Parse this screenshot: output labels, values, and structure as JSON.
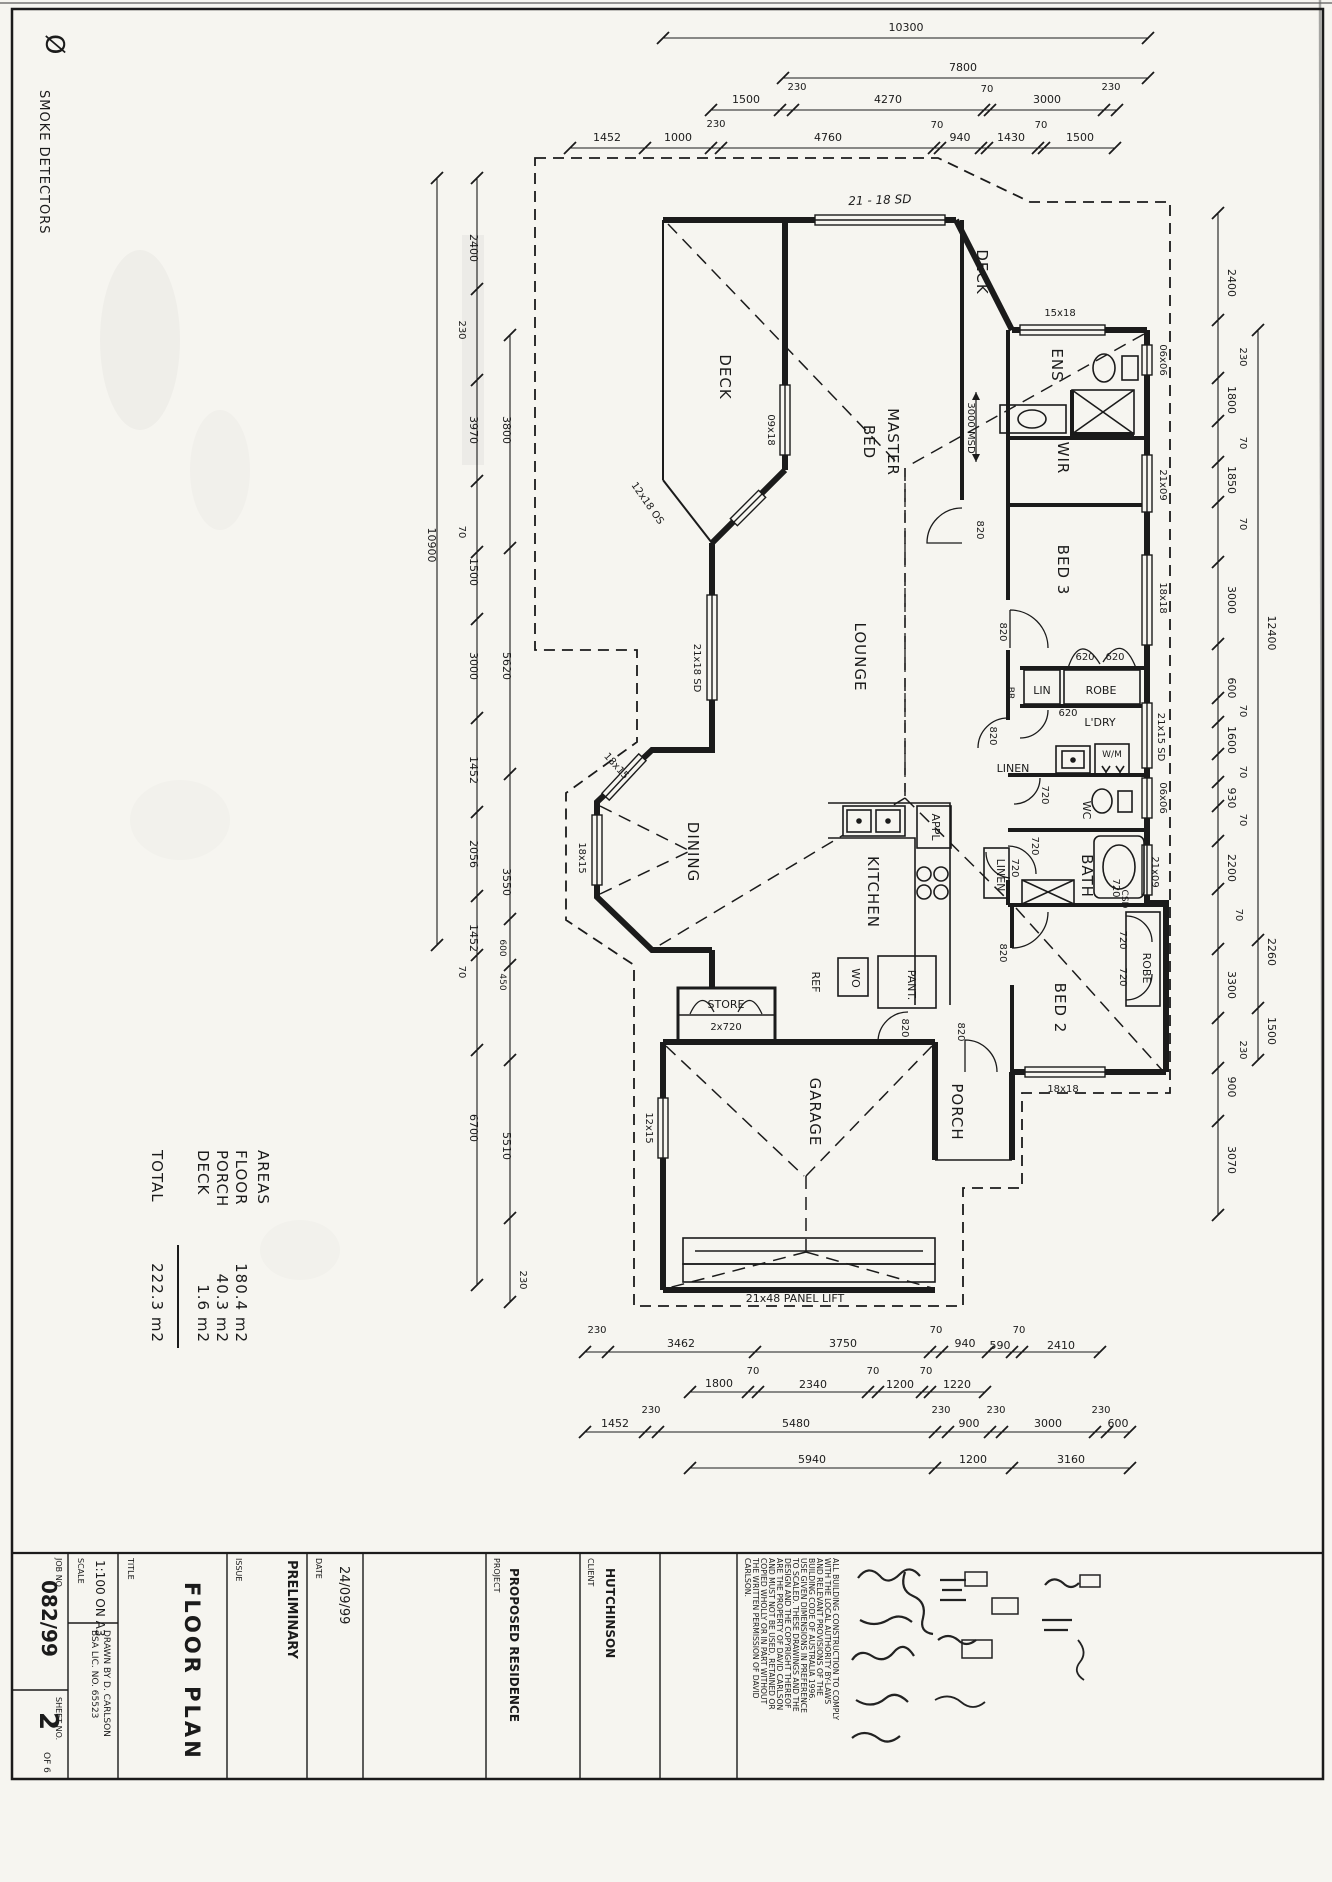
{
  "legend": {
    "symbol": "Ø",
    "label": "SMOKE DETECTORS"
  },
  "areas": {
    "title": "AREAS",
    "rows": [
      {
        "label": "FLOOR",
        "value": "180.4 m2"
      },
      {
        "label": "PORCH",
        "value": "40.3 m2"
      },
      {
        "label": "DECK",
        "value": "1.6 m2"
      }
    ],
    "total_label": "TOTAL",
    "total_value": "222.3 m2"
  },
  "rooms": {
    "deck_a": "DECK",
    "deck_b": "DECK",
    "master_1": "MASTER",
    "master_2": "BED",
    "ens": "ENS",
    "wir": "WIR",
    "bed3": "BED 3",
    "lounge": "LOUNGE",
    "dining": "DINING",
    "kitchen": "KITCHEN",
    "ldry": "L'DRY",
    "bath": "BATH",
    "bed2": "BED 2",
    "garage": "GARAGE",
    "porch": "PORCH",
    "store": "STORE",
    "wc": "WC",
    "lin": "LIN",
    "linen_hall": "LINEN",
    "linen_bath": "LINEN",
    "robe_bed3": "ROBE",
    "robe_bed2": "ROBE",
    "pant": "PANT.",
    "ref": "REF",
    "wo": "WO",
    "appl": "APPL",
    "wm": "W/M",
    "br": "BR",
    "csd": "CSD"
  },
  "win": {
    "a": "09x18",
    "b": "12x18 OS",
    "c": "21x18 SD",
    "d": "18x15",
    "e": "12x15",
    "f": "15x18",
    "g": "06x06",
    "h": "21x09",
    "i": "18x18",
    "j": "21x15 SD"
  },
  "doors": {
    "d820": "820",
    "d720": "720",
    "d620": "620",
    "two720": "2x720"
  },
  "notes": {
    "msd": "3000 MSD",
    "sd": "21 - 18 SD",
    "panel": "21x48 PANEL LIFT"
  },
  "d": {
    "t1": "10300",
    "t2": "7800",
    "t3": [
      "1500",
      "230",
      "4270",
      "70",
      "3000",
      "230"
    ],
    "t4": [
      "1452",
      "1000",
      "230",
      "4760",
      "70",
      "940",
      "1430",
      "70",
      "1500"
    ],
    "lo": "10900",
    "la": [
      "2400",
      "230",
      "3970",
      "70",
      "1500",
      "3000",
      "1452",
      "2056",
      "1452",
      "70",
      "6700"
    ],
    "lb": [
      "3800",
      "5620",
      "3550",
      "600",
      "450",
      "5510",
      "230"
    ],
    "ra": [
      "2400",
      "230",
      "1800",
      "70",
      "1850",
      "70",
      "3000",
      "600",
      "70",
      "1600",
      "70",
      "930",
      "70",
      "2200",
      "70",
      "3300",
      "230",
      "900",
      "3070"
    ],
    "rb": [
      "12400",
      "2260",
      "1500"
    ],
    "b1": [
      "230",
      "3462",
      "3750",
      "70",
      "940",
      "590",
      "70",
      "2410"
    ],
    "b2": [
      "1800",
      "70",
      "2340",
      "70",
      "1200",
      "70",
      "1220"
    ],
    "b3": [
      "1452",
      "230",
      "5480",
      "230",
      "900",
      "230",
      "3000",
      "230",
      "600"
    ],
    "b4": [
      "5940",
      "1200",
      "3160"
    ]
  },
  "title_block": {
    "job_label": "JOB NO.",
    "job": "082/99",
    "sheet_label": "SHEET NO.",
    "sheet": "2",
    "sheet_of": "OF 6",
    "scale_label": "SCALE",
    "scale": "1:100 ON A3",
    "drawn": "DRAWN BY  D. CARLSON",
    "lic": "BSA LIC. NO. 65523",
    "title_label": "TITLE",
    "title": "FLOOR PLAN",
    "issue_label": "ISSUE",
    "issue": "PRELIMINARY",
    "date_label": "DATE",
    "date": "24/09/99",
    "project_label": "PROJECT",
    "project": "PROPOSED RESIDENCE",
    "client_label": "CLIENT",
    "client": "HUTCHINSON",
    "notes": [
      "ALL BUILDING CONSTRUCTION TO COMPLY",
      "WITH THE LOCAL AUTHORITY BY-LAWS",
      "AND RELEVANT PROVISIONS OF THE",
      "BUILDING CODE OF AUSTRALIA 1996.",
      "USE GIVEN DIMENSIONS IN PREFERENCE",
      "TO SCALED. THESE DRAWINGS AND THE",
      "DESIGN AND THE COPYRIGHT THEREOF",
      "ARE THE PROPERTY OF DAVID CARLSON",
      "AND MUST NOT BE USED, RETAINED OR",
      "COPIED WHOLLY OR IN PART WITHOUT",
      "THE WRITTEN PERMISSION OF DAVID",
      "CARLSON."
    ]
  }
}
